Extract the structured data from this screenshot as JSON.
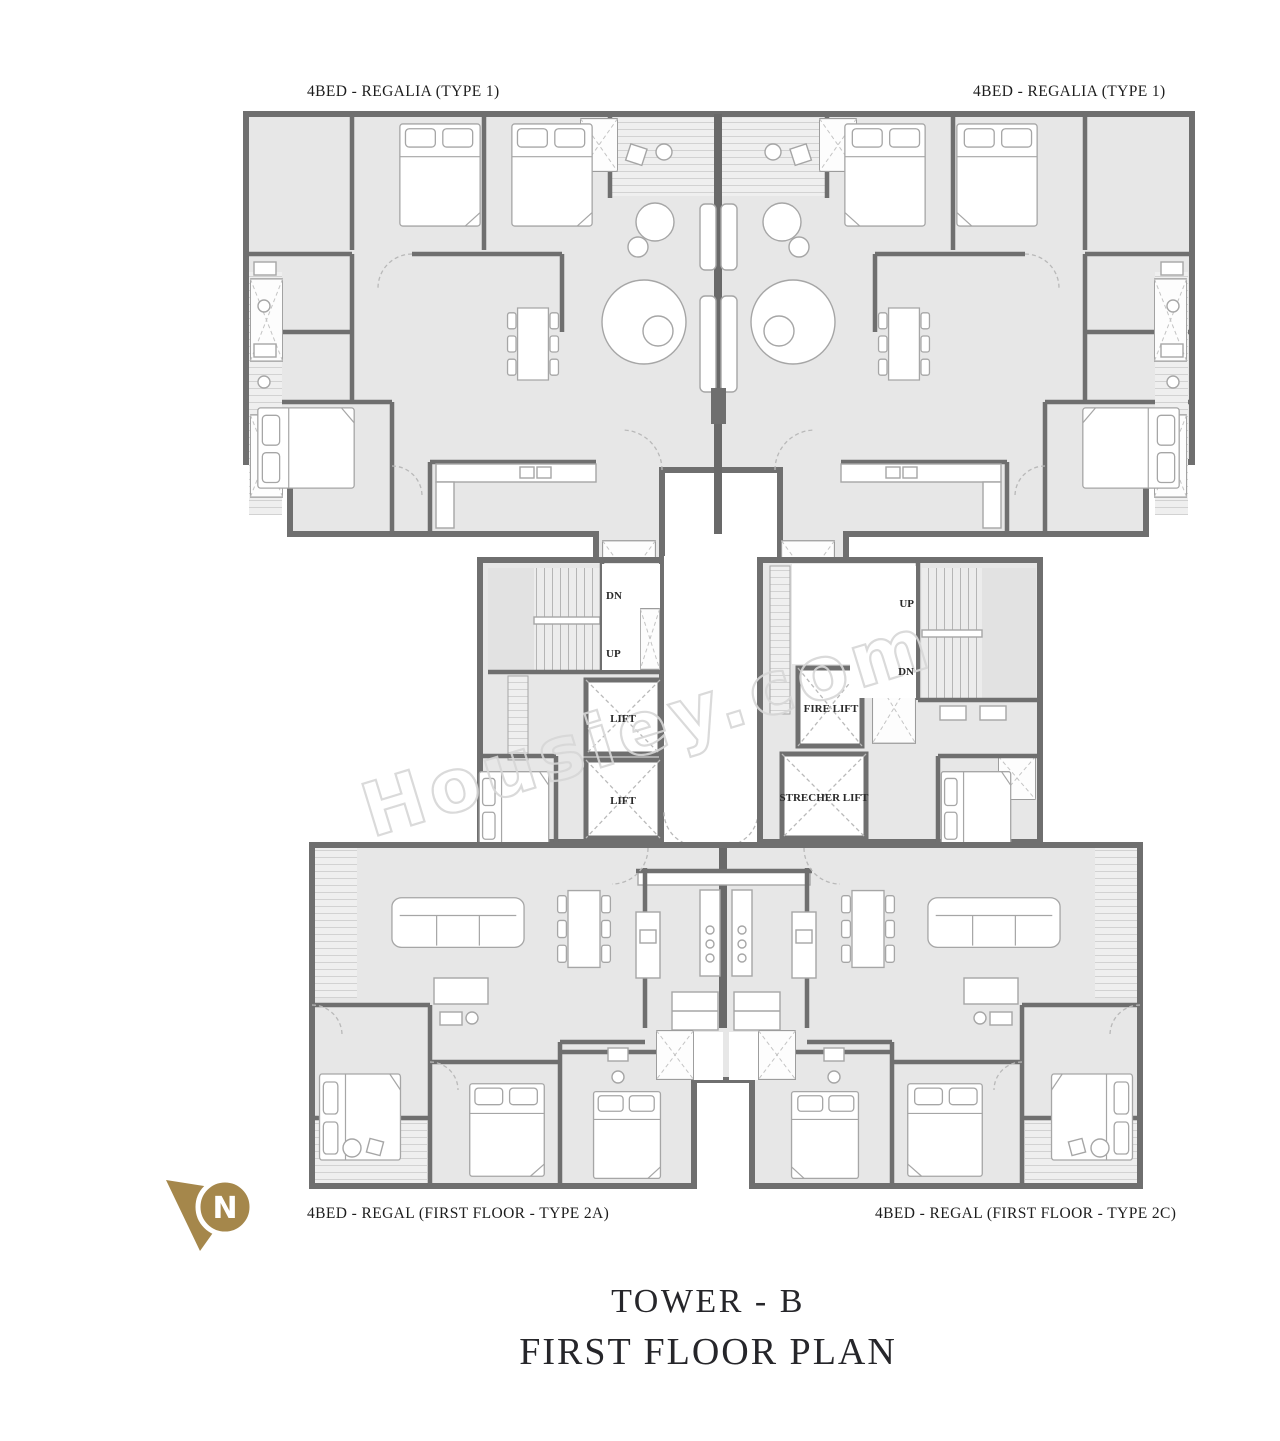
{
  "page": {
    "background": "#ffffff"
  },
  "plan": {
    "units": {
      "top_left": "4BED - REGALIA (TYPE 1)",
      "top_right": "4BED - REGALIA (TYPE 1)",
      "bottom_left": "4BED - REGAL (FIRST FLOOR - TYPE 2A)",
      "bottom_right": "4BED - REGAL (FIRST FLOOR - TYPE 2C)"
    },
    "core": {
      "left_stair": {
        "dn": "DN",
        "up": "UP"
      },
      "right_stair": {
        "up": "UP",
        "dn": "DN"
      },
      "lift_top": "LIFT",
      "lift_bottom": "LIFT",
      "fire_lift": "FIRE LIFT",
      "stretcher_lift": "STRECHER LIFT"
    }
  },
  "watermark": "Housiey.com",
  "north": {
    "letter": "N",
    "color": "#a5874b"
  },
  "title": {
    "line1": "TOWER - B",
    "line2": "FIRST FLOOR PLAN"
  },
  "colors": {
    "floor": "#e7e7e7",
    "wall": "#6f6f6f",
    "accent_gold": "#a5874b",
    "watermark": "#d7d7d7",
    "label_text": "#1d1d1d",
    "title_text": "#26262a"
  }
}
